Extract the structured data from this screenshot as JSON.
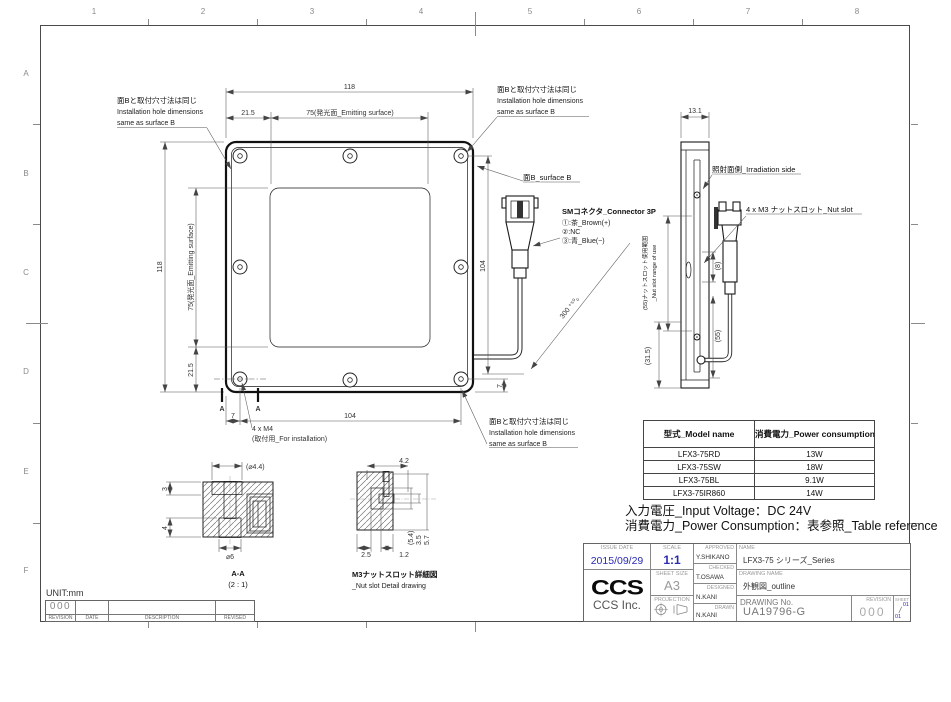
{
  "colors": {
    "accent": "#2a2ab4"
  },
  "grid": {
    "cols": [
      "1",
      "2",
      "3",
      "4",
      "5",
      "6",
      "7",
      "8"
    ],
    "rows": [
      "A",
      "B",
      "C",
      "D",
      "E",
      "F"
    ]
  },
  "front": {
    "dim_width": "118",
    "dim_offset": "21.5",
    "dim_emitting": "75(発光面_Emitting surface)",
    "dim_height": "118",
    "dim_height_offset": "21.5",
    "dim_holes": "104",
    "dim_hole_edge": "7",
    "dim_right": "104",
    "dim_right_edge": "7",
    "cable_length": "300 ⁺⁵⁰₀",
    "note_jp": "面Bと取付穴寸法は同じ",
    "note_en1": "Installation hole dimensions",
    "note_en2": "same as surface B",
    "surface_b": "面B_surface B",
    "connector_title": "SMコネクタ_Connector 3P",
    "pin1": "①:茶_Brown(+)",
    "pin2": "②:NC",
    "pin3": "③:青_Blue(−)",
    "m4_line1": "4 x M4",
    "m4_line2": "(取付用_For installation)",
    "section_mark": "A"
  },
  "side": {
    "dim_width": "13.1",
    "irradiation": "照射面側_Irradiation side",
    "nut_slot": "4 x M3 ナットスロット_Nut slot",
    "range_jp": "(55)ナットスロット使用範囲",
    "range_en": "_Nut slot range of use",
    "dim_8": "(8)",
    "dim_55": "(55)",
    "dim_315": "(31.5)"
  },
  "section_aa": {
    "title": "A-A",
    "scale": "(2 : 1)",
    "dim_cbore": "(⌀4.4)",
    "dim_3": "3",
    "dim_4": "4",
    "dim_6": "⌀6"
  },
  "nut_detail": {
    "title_jp": "M3ナットスロット詳細図",
    "title_en": "_Nut slot Detail drawing",
    "dim_42": "4.2",
    "dim_54": "(5.4)",
    "dim_35": "3.5",
    "dim_57": "5.7",
    "dim_25": "2.5",
    "dim_12": "1.2"
  },
  "table": {
    "headers": [
      "型式_Model name",
      "消費電力_Power consumption"
    ],
    "rows": [
      [
        "LFX3-75RD",
        "13W"
      ],
      [
        "LFX3-75SW",
        "18W"
      ],
      [
        "LFX3-75BL",
        "9.1W"
      ],
      [
        "LFX3-75IR860",
        "14W"
      ]
    ]
  },
  "notes": {
    "voltage": "入力電圧_Input Voltage：DC 24V",
    "power": "消費電力_Power Consumption：表参照_Table reference"
  },
  "titleblock": {
    "issue_date_label": "ISSUE DATE",
    "issue_date": "2015/09/29",
    "scale_label": "SCALE",
    "scale": "1:1",
    "sheet_size_label": "SHEET SIZE",
    "sheet_size": "A3",
    "projection_label": "PROJECTION",
    "approved_label": "APPROVED",
    "approved": "Y.SHIKANO",
    "checked_label": "CHECKED",
    "checked": "T.OSAWA",
    "designed_label": "DESIGNED",
    "designed": "N.KANI",
    "drawn_label": "DRAWN",
    "drawn": "N.KANI",
    "name_label": "NAME",
    "name": "LFX3-75 シリーズ_Series",
    "drawing_name_label": "DRAWING NAME",
    "drawing_name": "外観図_outline",
    "drawing_no_label": "DRAWING No.",
    "drawing_no": "UA19796-G",
    "revision_label": "REVISION",
    "revision": "000",
    "sheet_label": "SHEET",
    "sheet_top": "01",
    "sheet_sep": "/",
    "sheet_bot": "01",
    "logo": "CCS",
    "company": "CCS Inc."
  },
  "strip": {
    "unit": "UNIT:mm",
    "value": "000",
    "labels": [
      "REVISION",
      "DATE",
      "DESCRIPTION",
      "REVISED"
    ]
  }
}
